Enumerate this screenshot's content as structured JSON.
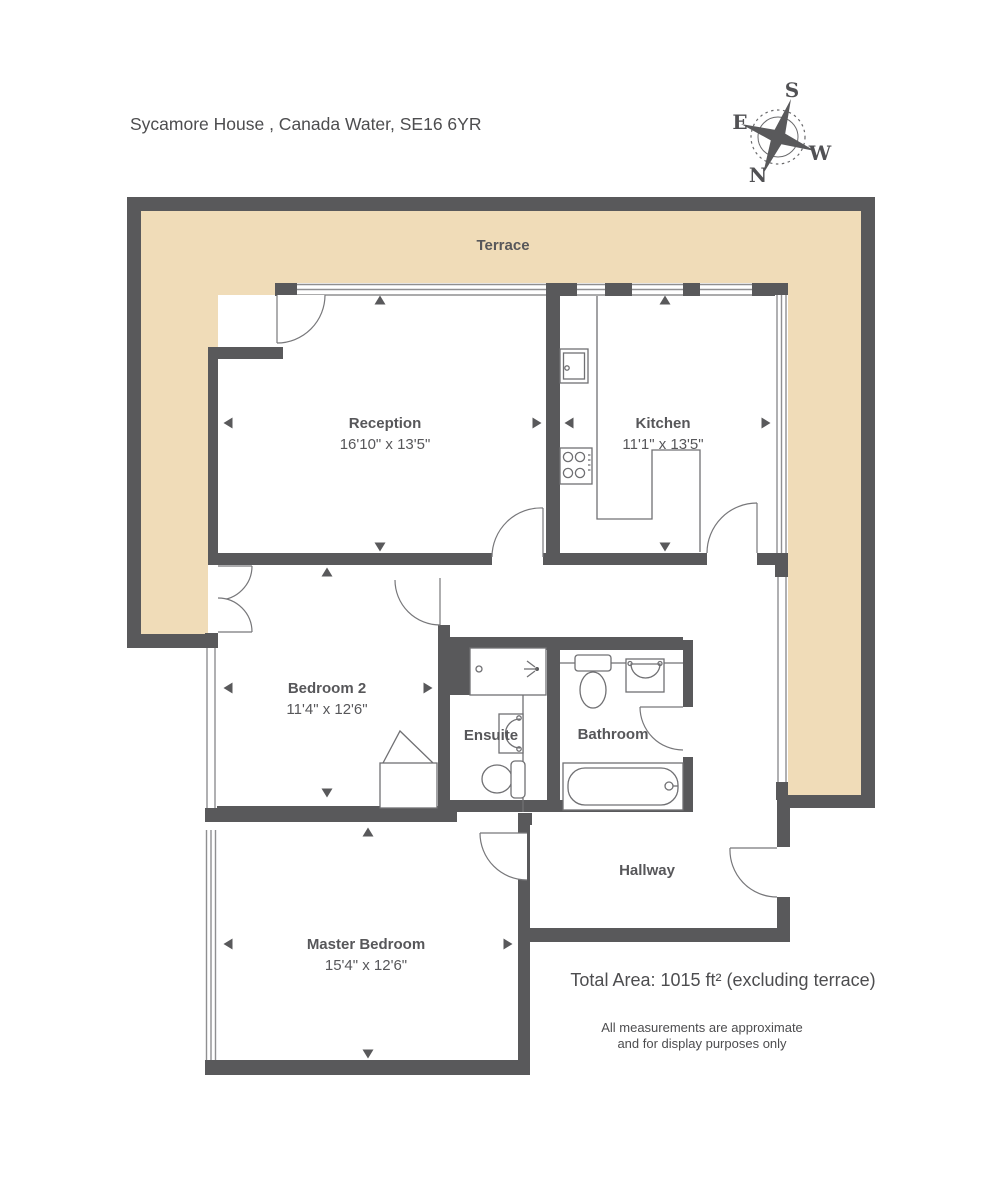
{
  "title": "Sycamore House , Canada Water, SE16 6YR",
  "compass": {
    "north": "N",
    "east": "E",
    "south": "S",
    "west": "W"
  },
  "rooms": {
    "terrace": {
      "label": "Terrace"
    },
    "reception": {
      "label": "Reception",
      "dims": "16'10\" x 13'5\""
    },
    "kitchen": {
      "label": "Kitchen",
      "dims": "11'1\" x 13'5\""
    },
    "bedroom2": {
      "label": "Bedroom 2",
      "dims": "11'4\" x 12'6\""
    },
    "ensuite": {
      "label": "Ensuite"
    },
    "bathroom": {
      "label": "Bathroom"
    },
    "hallway": {
      "label": "Hallway"
    },
    "master": {
      "label": "Master Bedroom",
      "dims": "15'4\" x 12'6\""
    }
  },
  "footer": {
    "total_area": "Total Area: 1015 ft² (excluding terrace)",
    "disclaimer_line1": "All measurements are approximate",
    "disclaimer_line2": "and for display purposes only"
  },
  "colors": {
    "wall": "#59595b",
    "terrace_fill": "#f0dcb8",
    "text": "#57575a"
  }
}
